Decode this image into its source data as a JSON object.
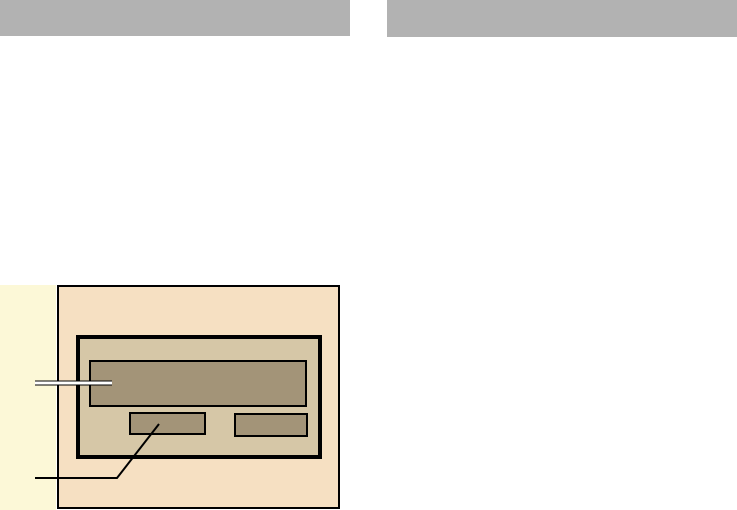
{
  "header": {
    "bar_color": "#b2b2b2",
    "left_bar": {
      "x": 0,
      "y": 0,
      "width": 350,
      "height": 36,
      "fill": "#b2b2b2"
    },
    "right_bar": {
      "x": 387,
      "y": 0,
      "width": 350,
      "height": 37,
      "fill": "#b2b2b2"
    }
  },
  "figure": {
    "side_panel": {
      "x": 0,
      "y": 285,
      "width": 56,
      "height": 225,
      "fill": "#fcf8d7"
    },
    "device_panel": {
      "x": 57,
      "y": 285,
      "width": 283,
      "height": 224,
      "fill": "#f6e0c2",
      "border": "#000000"
    },
    "bezel": {
      "x": 76,
      "y": 335,
      "width": 246,
      "height": 124,
      "fill": "#d6c7a7",
      "border": "#000000"
    },
    "display_screen": {
      "x": 89,
      "y": 360,
      "width": 218,
      "height": 47,
      "fill": "#a39478",
      "border": "#000000"
    },
    "left_button": {
      "x": 129,
      "y": 412,
      "width": 77,
      "height": 23,
      "fill": "#a39478",
      "border": "#000000"
    },
    "right_button": {
      "x": 234,
      "y": 413,
      "width": 74,
      "height": 24,
      "fill": "#a39478",
      "border": "#000000"
    },
    "callouts": {
      "display_callout": {
        "points": [
          [
            35,
            383
          ],
          [
            112,
            383
          ]
        ],
        "outline_color": "#000000",
        "core_color": "#ffffff"
      },
      "button_callout": {
        "points": [
          [
            35,
            478
          ],
          [
            117,
            478
          ],
          [
            159,
            424
          ]
        ],
        "line_color": "#000000"
      }
    }
  }
}
